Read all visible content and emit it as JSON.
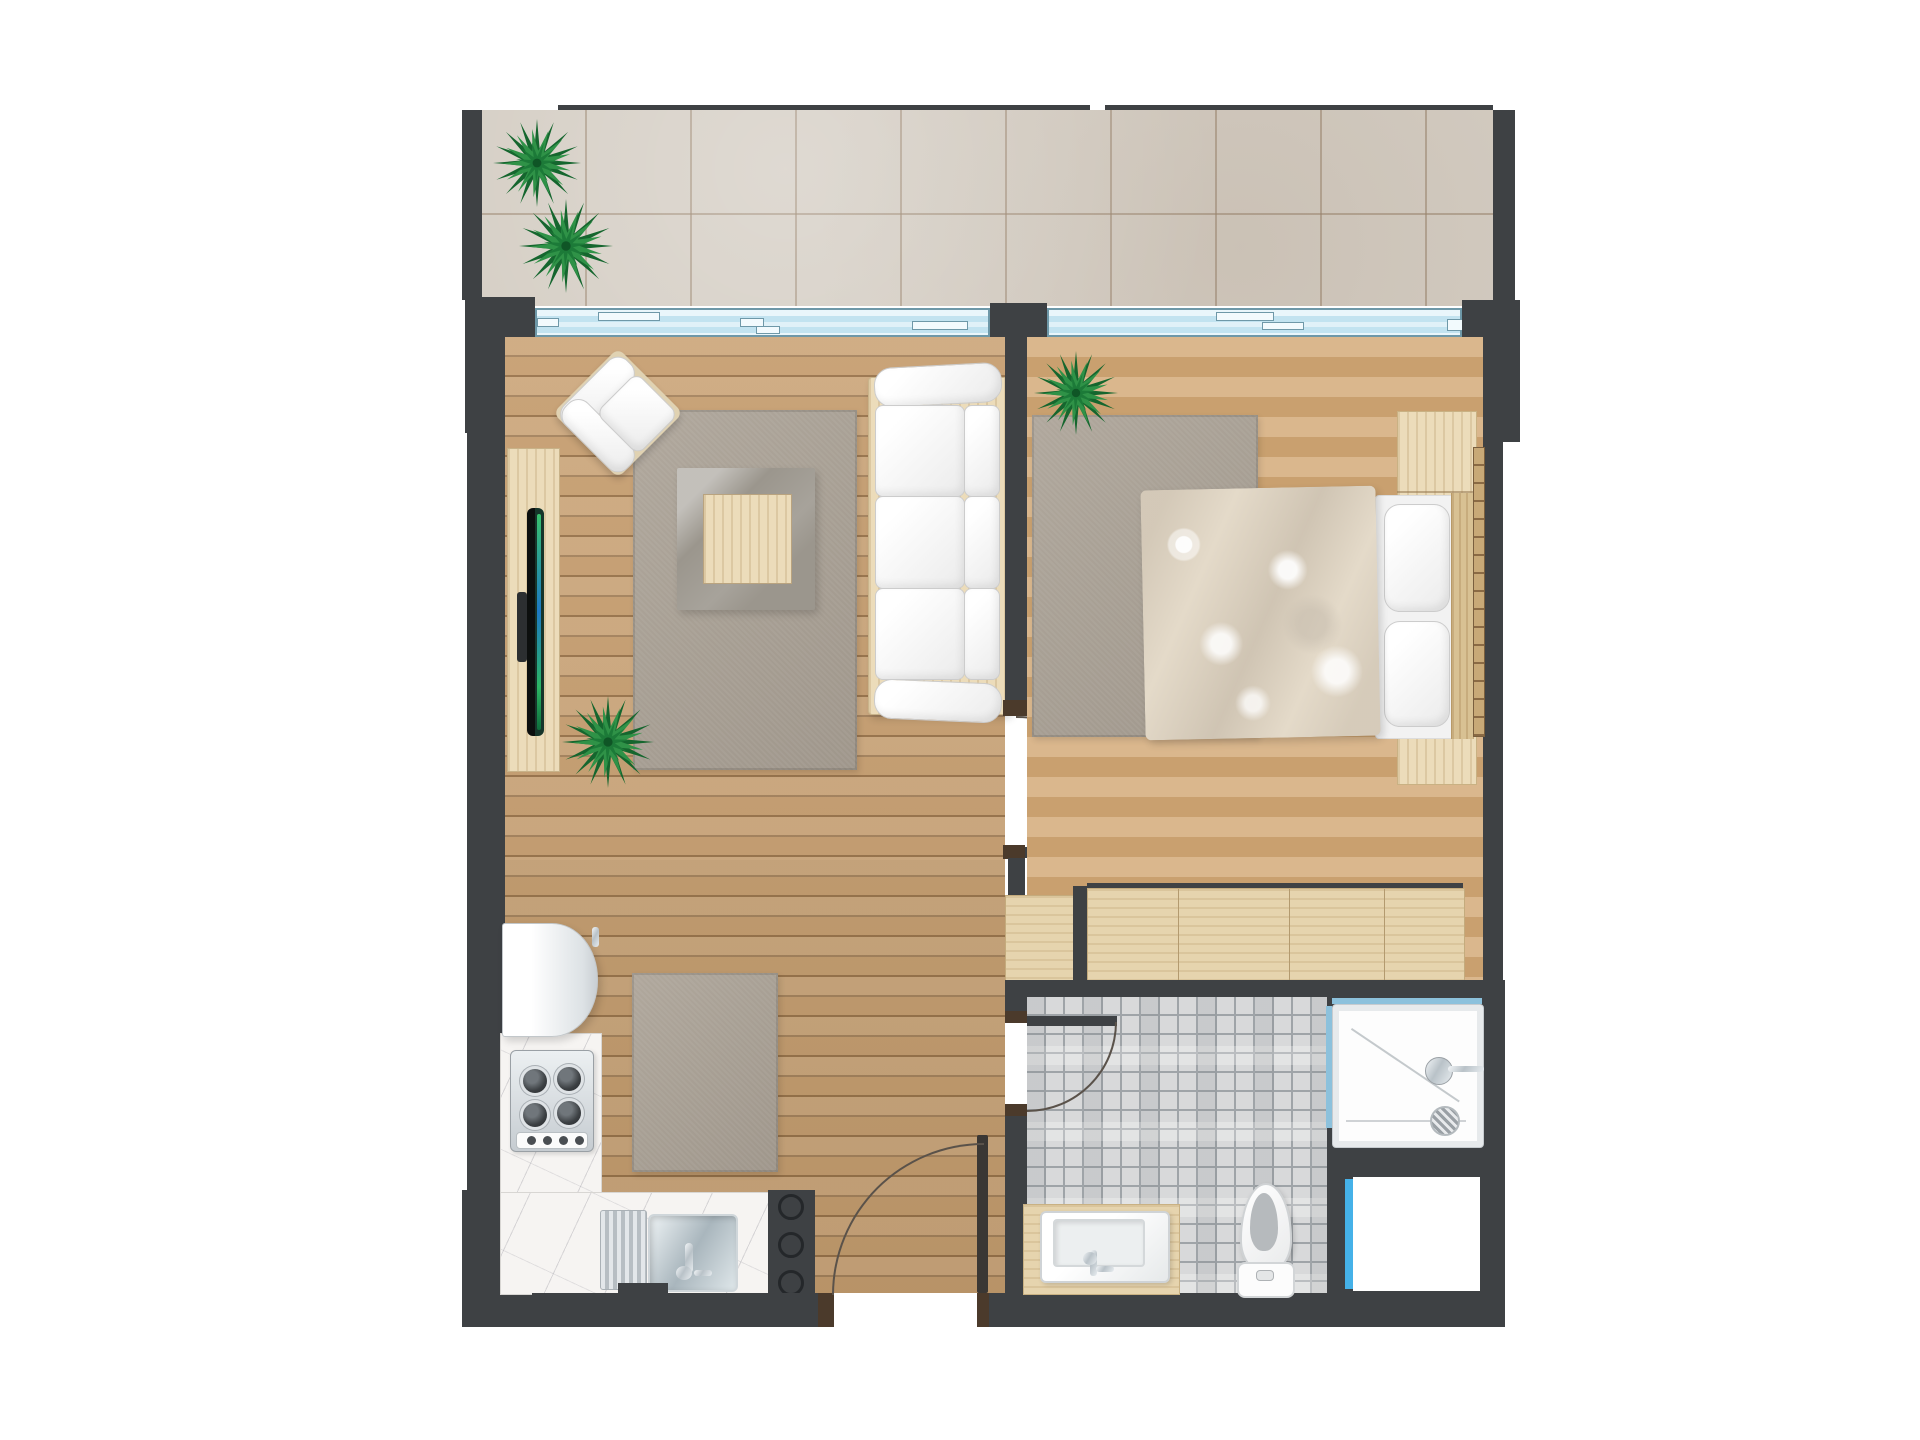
{
  "palette": {
    "wall": "#3e4144",
    "jamb": "#4b3a2b",
    "wood_floor": "#c69e70",
    "bedroom_floor": "#d0a97a",
    "balcony_tile": "#d4cdc3",
    "mosaic_tile": "#d8d9da",
    "rug_gray": "#a9a094",
    "glass_blue": "#cfe9f4",
    "accent_blue": "#45b1e8",
    "marble": "#f6f4f2",
    "cream_wood": "#ecdcba",
    "plant_green": "#2f9247",
    "white_fixture": "#ffffff"
  },
  "rooms": [
    "balcony",
    "living-room",
    "bedroom",
    "kitchen",
    "bathroom",
    "hallway"
  ],
  "plants": [
    {
      "id": "balcony-plant-1",
      "cx": 537,
      "cy": 163,
      "r": 44
    },
    {
      "id": "balcony-plant-2",
      "cx": 566,
      "cy": 246,
      "r": 47
    },
    {
      "id": "living-room-plant",
      "cx": 608,
      "cy": 742,
      "r": 46
    },
    {
      "id": "bedroom-plant",
      "cx": 1076,
      "cy": 393,
      "r": 42
    }
  ],
  "window_handles": [
    [
      537,
      318,
      22,
      9
    ],
    [
      598,
      312,
      62,
      9
    ],
    [
      740,
      318,
      24,
      9
    ],
    [
      756,
      326,
      24,
      8
    ],
    [
      912,
      321,
      56,
      9
    ],
    [
      1216,
      312,
      58,
      9
    ],
    [
      1262,
      322,
      42,
      8
    ],
    [
      1447,
      319,
      18,
      12
    ]
  ],
  "hob_burners": [
    [
      12,
      18
    ],
    [
      46,
      16
    ],
    [
      12,
      52
    ],
    [
      46,
      50
    ]
  ],
  "hob_knobs": [
    10,
    26,
    42,
    58
  ],
  "appliance_circles": [
    4,
    42,
    80
  ],
  "closet_seams": [
    90,
    201,
    296
  ]
}
